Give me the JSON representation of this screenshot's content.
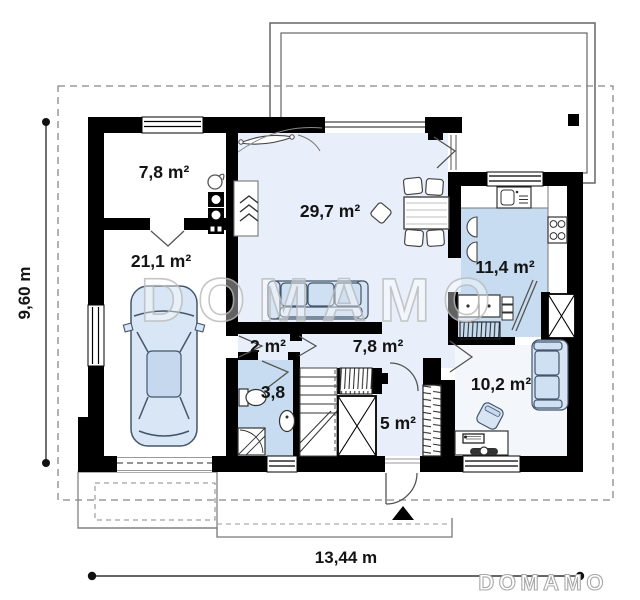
{
  "title": "House floor plan",
  "watermark": {
    "text": "DOMAMO"
  },
  "logo": {
    "text": "DOMAMO"
  },
  "rooms": [
    {
      "id": "boiler-room",
      "label": "7,8 m²"
    },
    {
      "id": "garage",
      "label": "21,1 m²"
    },
    {
      "id": "living-room",
      "label": "29,7 m²"
    },
    {
      "id": "kitchen",
      "label": "11,4 m²"
    },
    {
      "id": "corridor",
      "label": "2 m²"
    },
    {
      "id": "hall",
      "label": "7,8 m²"
    },
    {
      "id": "bathroom",
      "label": "3,8"
    },
    {
      "id": "vestibule",
      "label": "5 m²"
    },
    {
      "id": "office",
      "label": "10,2 m²"
    }
  ],
  "dimensions": {
    "height_label": "9,60 m",
    "width_label": "13,44 m"
  },
  "colors": {
    "wall": "#000000",
    "floor_light": "#e9effa",
    "floor_wet": "#c7dcf0",
    "furniture": "#d7e4f4",
    "outline": "#555555",
    "watermark": "#bdbdbd"
  }
}
